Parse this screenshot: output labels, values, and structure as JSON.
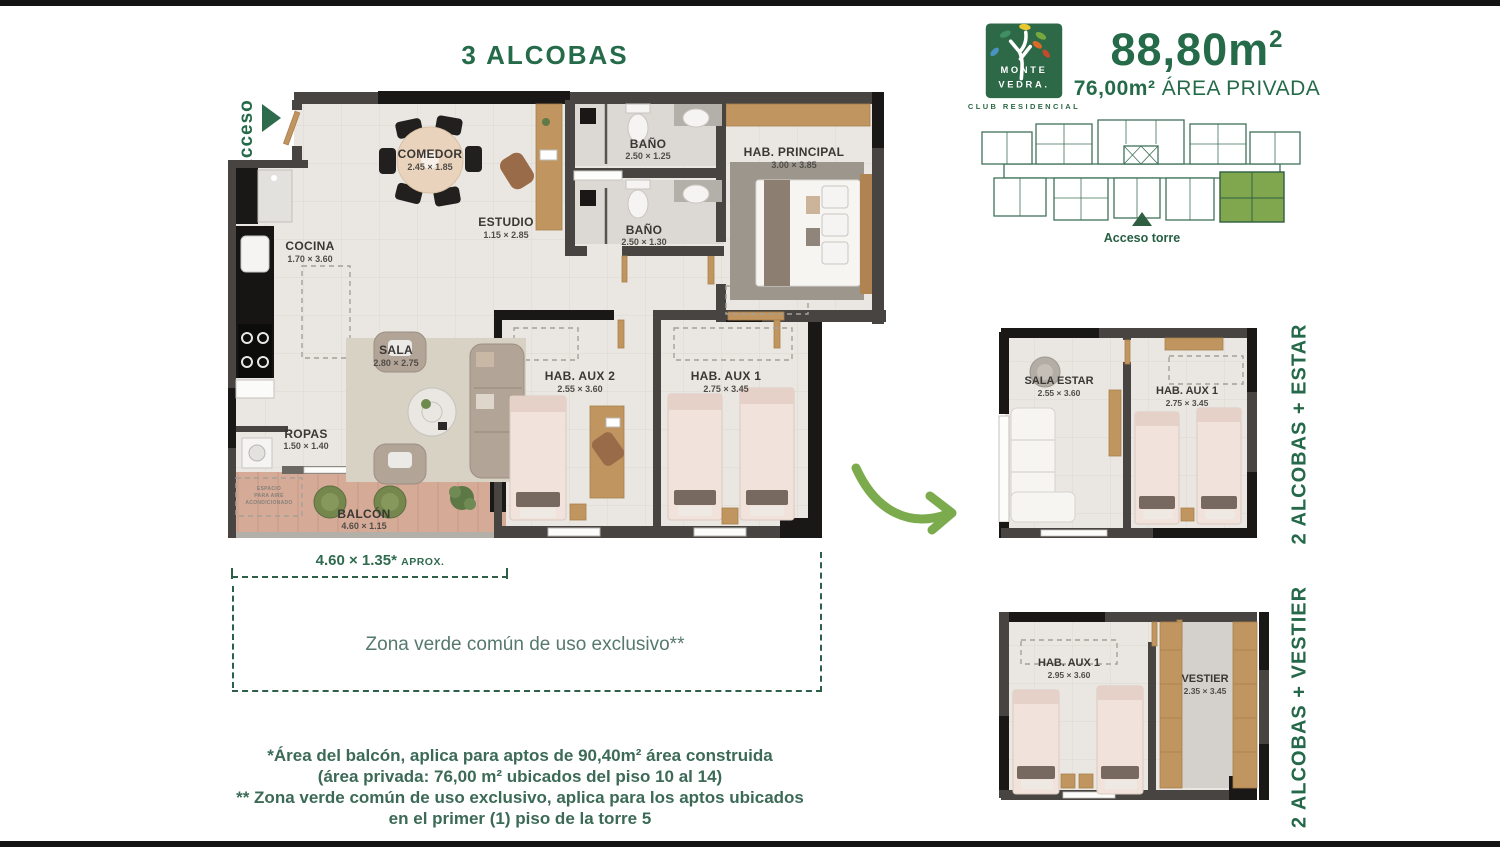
{
  "page": {
    "title": "3 ALCOBAS",
    "acceso": "Acceso"
  },
  "brand": {
    "logo_line1": "MONTE",
    "logo_line2": "VEDRA.",
    "logo_sub": "CLUB RESIDENCIAL",
    "area_total": "88,80m",
    "area_total_sup": "2",
    "area_private_value": "76,00m²",
    "area_private_label": "ÁREA PRIVADA",
    "tower_access": "Acceso torre"
  },
  "plan_main": {
    "rooms": {
      "comedor": {
        "name": "COMEDOR",
        "dims": "2.45 × 1.85"
      },
      "estudio": {
        "name": "ESTUDIO",
        "dims": "1.15 × 2.85"
      },
      "bano1": {
        "name": "BAÑO",
        "dims": "2.50 × 1.25"
      },
      "bano2": {
        "name": "BAÑO",
        "dims": "2.50 × 1.30"
      },
      "hab_principal": {
        "name": "HAB. PRINCIPAL",
        "dims": "3.00 × 3.85"
      },
      "cocina": {
        "name": "COCINA",
        "dims": "1.70 × 3.60"
      },
      "sala": {
        "name": "SALA",
        "dims": "2.80 × 2.75"
      },
      "ropas": {
        "name": "ROPAS",
        "dims": "1.50 × 1.40"
      },
      "balcon": {
        "name": "BALCÓN",
        "dims": "4.60 × 1.15"
      },
      "hab_aux2": {
        "name": "HAB. AUX 2",
        "dims": "2.55 × 3.60"
      },
      "hab_aux1": {
        "name": "HAB. AUX 1",
        "dims": "2.75 × 3.45"
      }
    },
    "ac_note": [
      "ESPACIO",
      "PARA AIRE",
      "ACONDICIONADO"
    ],
    "balcony_dim": "4.60 × 1.35*",
    "balcony_dim_suffix": "APROX.",
    "green_zone": "Zona verde común de uso exclusivo**"
  },
  "plan_estar": {
    "side_label": "2 ALCOBAS + ESTAR",
    "rooms": {
      "sala_estar": {
        "name": "SALA ESTAR",
        "dims": "2.55 × 3.60"
      },
      "hab_aux1": {
        "name": "HAB. AUX 1",
        "dims": "2.75 × 3.45"
      }
    }
  },
  "plan_vestier": {
    "side_label": "2 ALCOBAS + VESTIER",
    "rooms": {
      "hab_aux1": {
        "name": "HAB. AUX 1",
        "dims": "2.95 × 3.60"
      },
      "vestier": {
        "name": "VESTIER",
        "dims": "2.35 × 3.45"
      }
    }
  },
  "footnotes": [
    "*Área del balcón, aplica para aptos de 90,40m² área construida",
    "(área privada: 76,00 m² ubicados del piso 10 al 14)",
    "** Zona verde común de uso exclusivo, aplica para los aptos ubicados",
    "en el primer (1) piso de la torre 5"
  ],
  "colors": {
    "brand_green": "#256B49",
    "accent_green": "#7CAB4D",
    "muted_teal": "#56796D",
    "wall_dark": "#474441",
    "wall_black": "#191817",
    "floor_light": "#EAE7E2",
    "balcony_wood": "#D5AA96",
    "highlight_unit": "#81A74E"
  }
}
